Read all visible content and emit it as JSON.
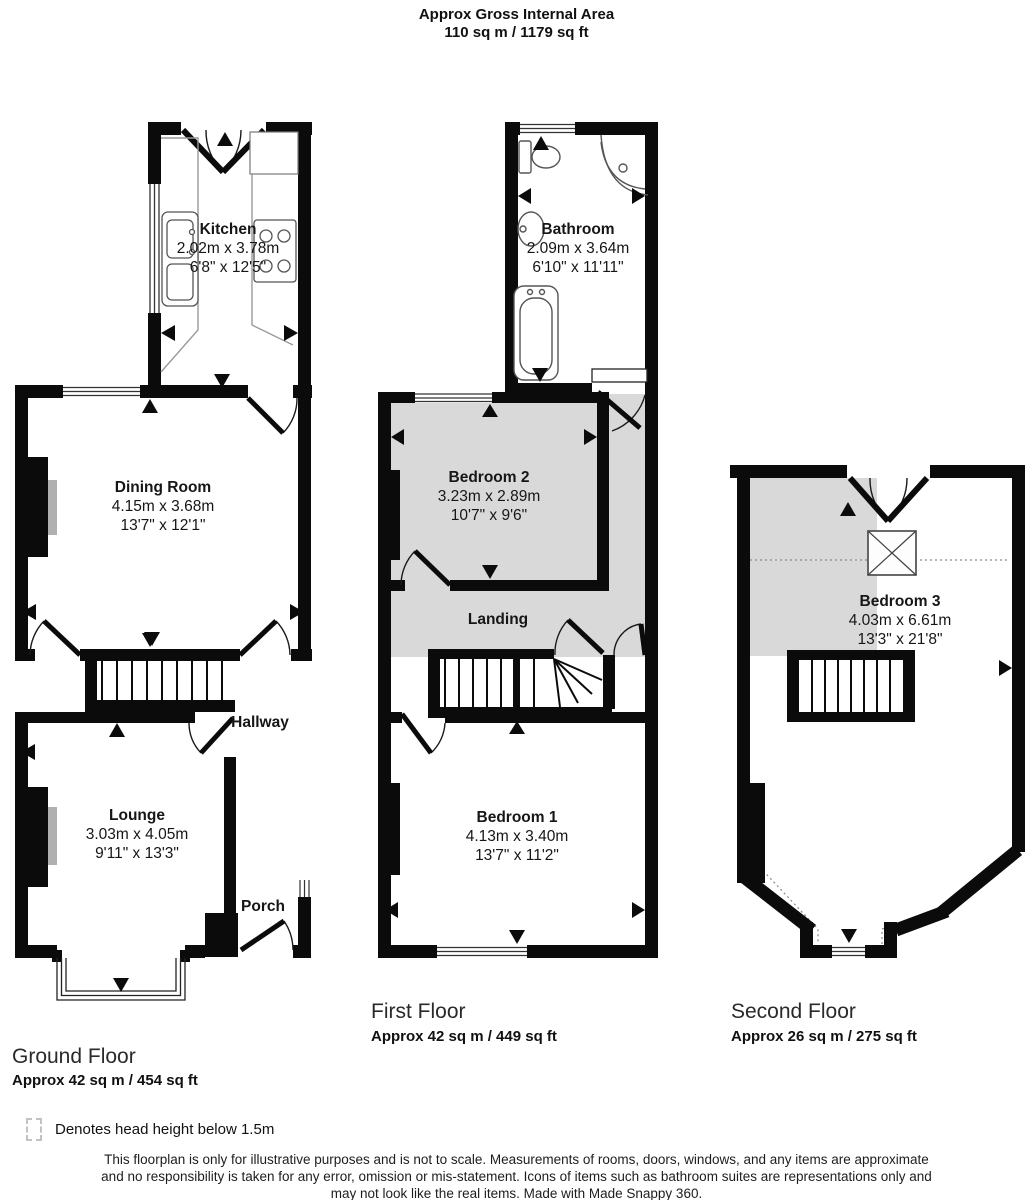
{
  "header": {
    "title": "Approx Gross Internal Area",
    "subtitle": "110 sq m / 1179 sq ft"
  },
  "floors": {
    "ground": {
      "title": "Ground Floor",
      "area": "Approx 42 sq m / 454 sq ft",
      "rooms": {
        "kitchen": {
          "name": "Kitchen",
          "metric": "2.02m x 3.78m",
          "imperial": "6'8\" x 12'5\""
        },
        "dining": {
          "name": "Dining Room",
          "metric": "4.15m x 3.68m",
          "imperial": "13'7\" x 12'1\""
        },
        "hallway": {
          "name": "Hallway"
        },
        "lounge": {
          "name": "Lounge",
          "metric": "3.03m x 4.05m",
          "imperial": "9'11\" x 13'3\""
        },
        "porch": {
          "name": "Porch"
        }
      }
    },
    "first": {
      "title": "First Floor",
      "area": "Approx 42 sq m / 449 sq ft",
      "rooms": {
        "bathroom": {
          "name": "Bathroom",
          "metric": "2.09m x 3.64m",
          "imperial": "6'10\" x 11'11\""
        },
        "bedroom2": {
          "name": "Bedroom 2",
          "metric": "3.23m x 2.89m",
          "imperial": "10'7\" x 9'6\""
        },
        "landing": {
          "name": "Landing"
        },
        "bedroom1": {
          "name": "Bedroom 1",
          "metric": "4.13m x 3.40m",
          "imperial": "13'7\" x 11'2\""
        }
      }
    },
    "second": {
      "title": "Second Floor",
      "area": "Approx 26 sq m / 275 sq ft",
      "rooms": {
        "bedroom3": {
          "name": "Bedroom 3",
          "metric": "4.03m x 6.61m",
          "imperial": "13'3\" x 21'8\""
        }
      }
    }
  },
  "legend": {
    "text": "Denotes head height below 1.5m"
  },
  "disclaimer": {
    "line1": "This floorplan is only for illustrative purposes and is not to scale. Measurements of rooms, doors, windows, and any items are approximate",
    "line2": "and no responsibility is taken for any error, omission or mis-statement. Icons of items such as bathroom suites are representations only and",
    "line3": "may not look like the real items. Made with Made Snappy 360."
  },
  "colors": {
    "wall": "#0b0b0b",
    "head_height_shade": "#d9d9d9",
    "fixture_stroke": "#555555"
  }
}
